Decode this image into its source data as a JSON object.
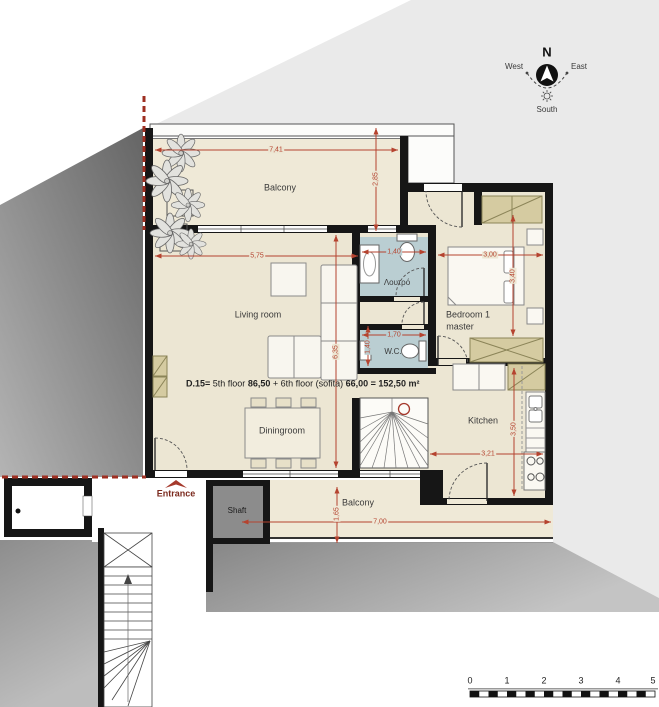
{
  "unit_area_label": {
    "segments": [
      {
        "text": "D.15=",
        "bold": true
      },
      {
        "text": " 5th floor ",
        "bold": false
      },
      {
        "text": "86,50",
        "bold": true
      },
      {
        "text": " + 6th floor (sofita) ",
        "bold": false
      },
      {
        "text": "66,00 = 152,50 m²",
        "bold": true
      }
    ]
  },
  "rooms": {
    "balcony_top": "Balcony",
    "living": "Living room",
    "dining": "Diningroom",
    "bedroom_line1": "Bedroom 1",
    "bedroom_line2": "master",
    "bath": "Λουτρό",
    "wc": "W.C.",
    "kitchen": "Kitchen",
    "balcony_bottom": "Balcony",
    "shaft": "Shaft",
    "entrance": "Entrance"
  },
  "dimensions": {
    "balcony_top_width": "7,41",
    "balcony_top_depth": "2,85",
    "living_width": "5,75",
    "living_depth": "6,35",
    "bathroom_width": "1,40",
    "bedroom_width": "3,00",
    "bedroom_depth": "3,40",
    "wc_width": "1,70",
    "wc_depth": "1,40",
    "kitchen_depth": "3,50",
    "kitchen_width": "3,21",
    "balcony_bottom_width": "7,00",
    "balcony_bottom_depth": "1,65"
  },
  "compass": {
    "north": "N",
    "west": "West",
    "east": "East",
    "south": "South"
  },
  "scale_bar": {
    "ticks": [
      "0",
      "1",
      "2",
      "3",
      "4",
      "5"
    ]
  },
  "colors": {
    "wall": "#161616",
    "floor_cream": "#ECE6D3",
    "wet_room_blue": "#BACED2",
    "dimension_red": "#B5432F",
    "boundary_red": "#9E2F22",
    "entrance_maroon": "#7B2A1E",
    "furniture_tan": "#D5CBA1",
    "site_light_gray": "#EAEAEA"
  }
}
